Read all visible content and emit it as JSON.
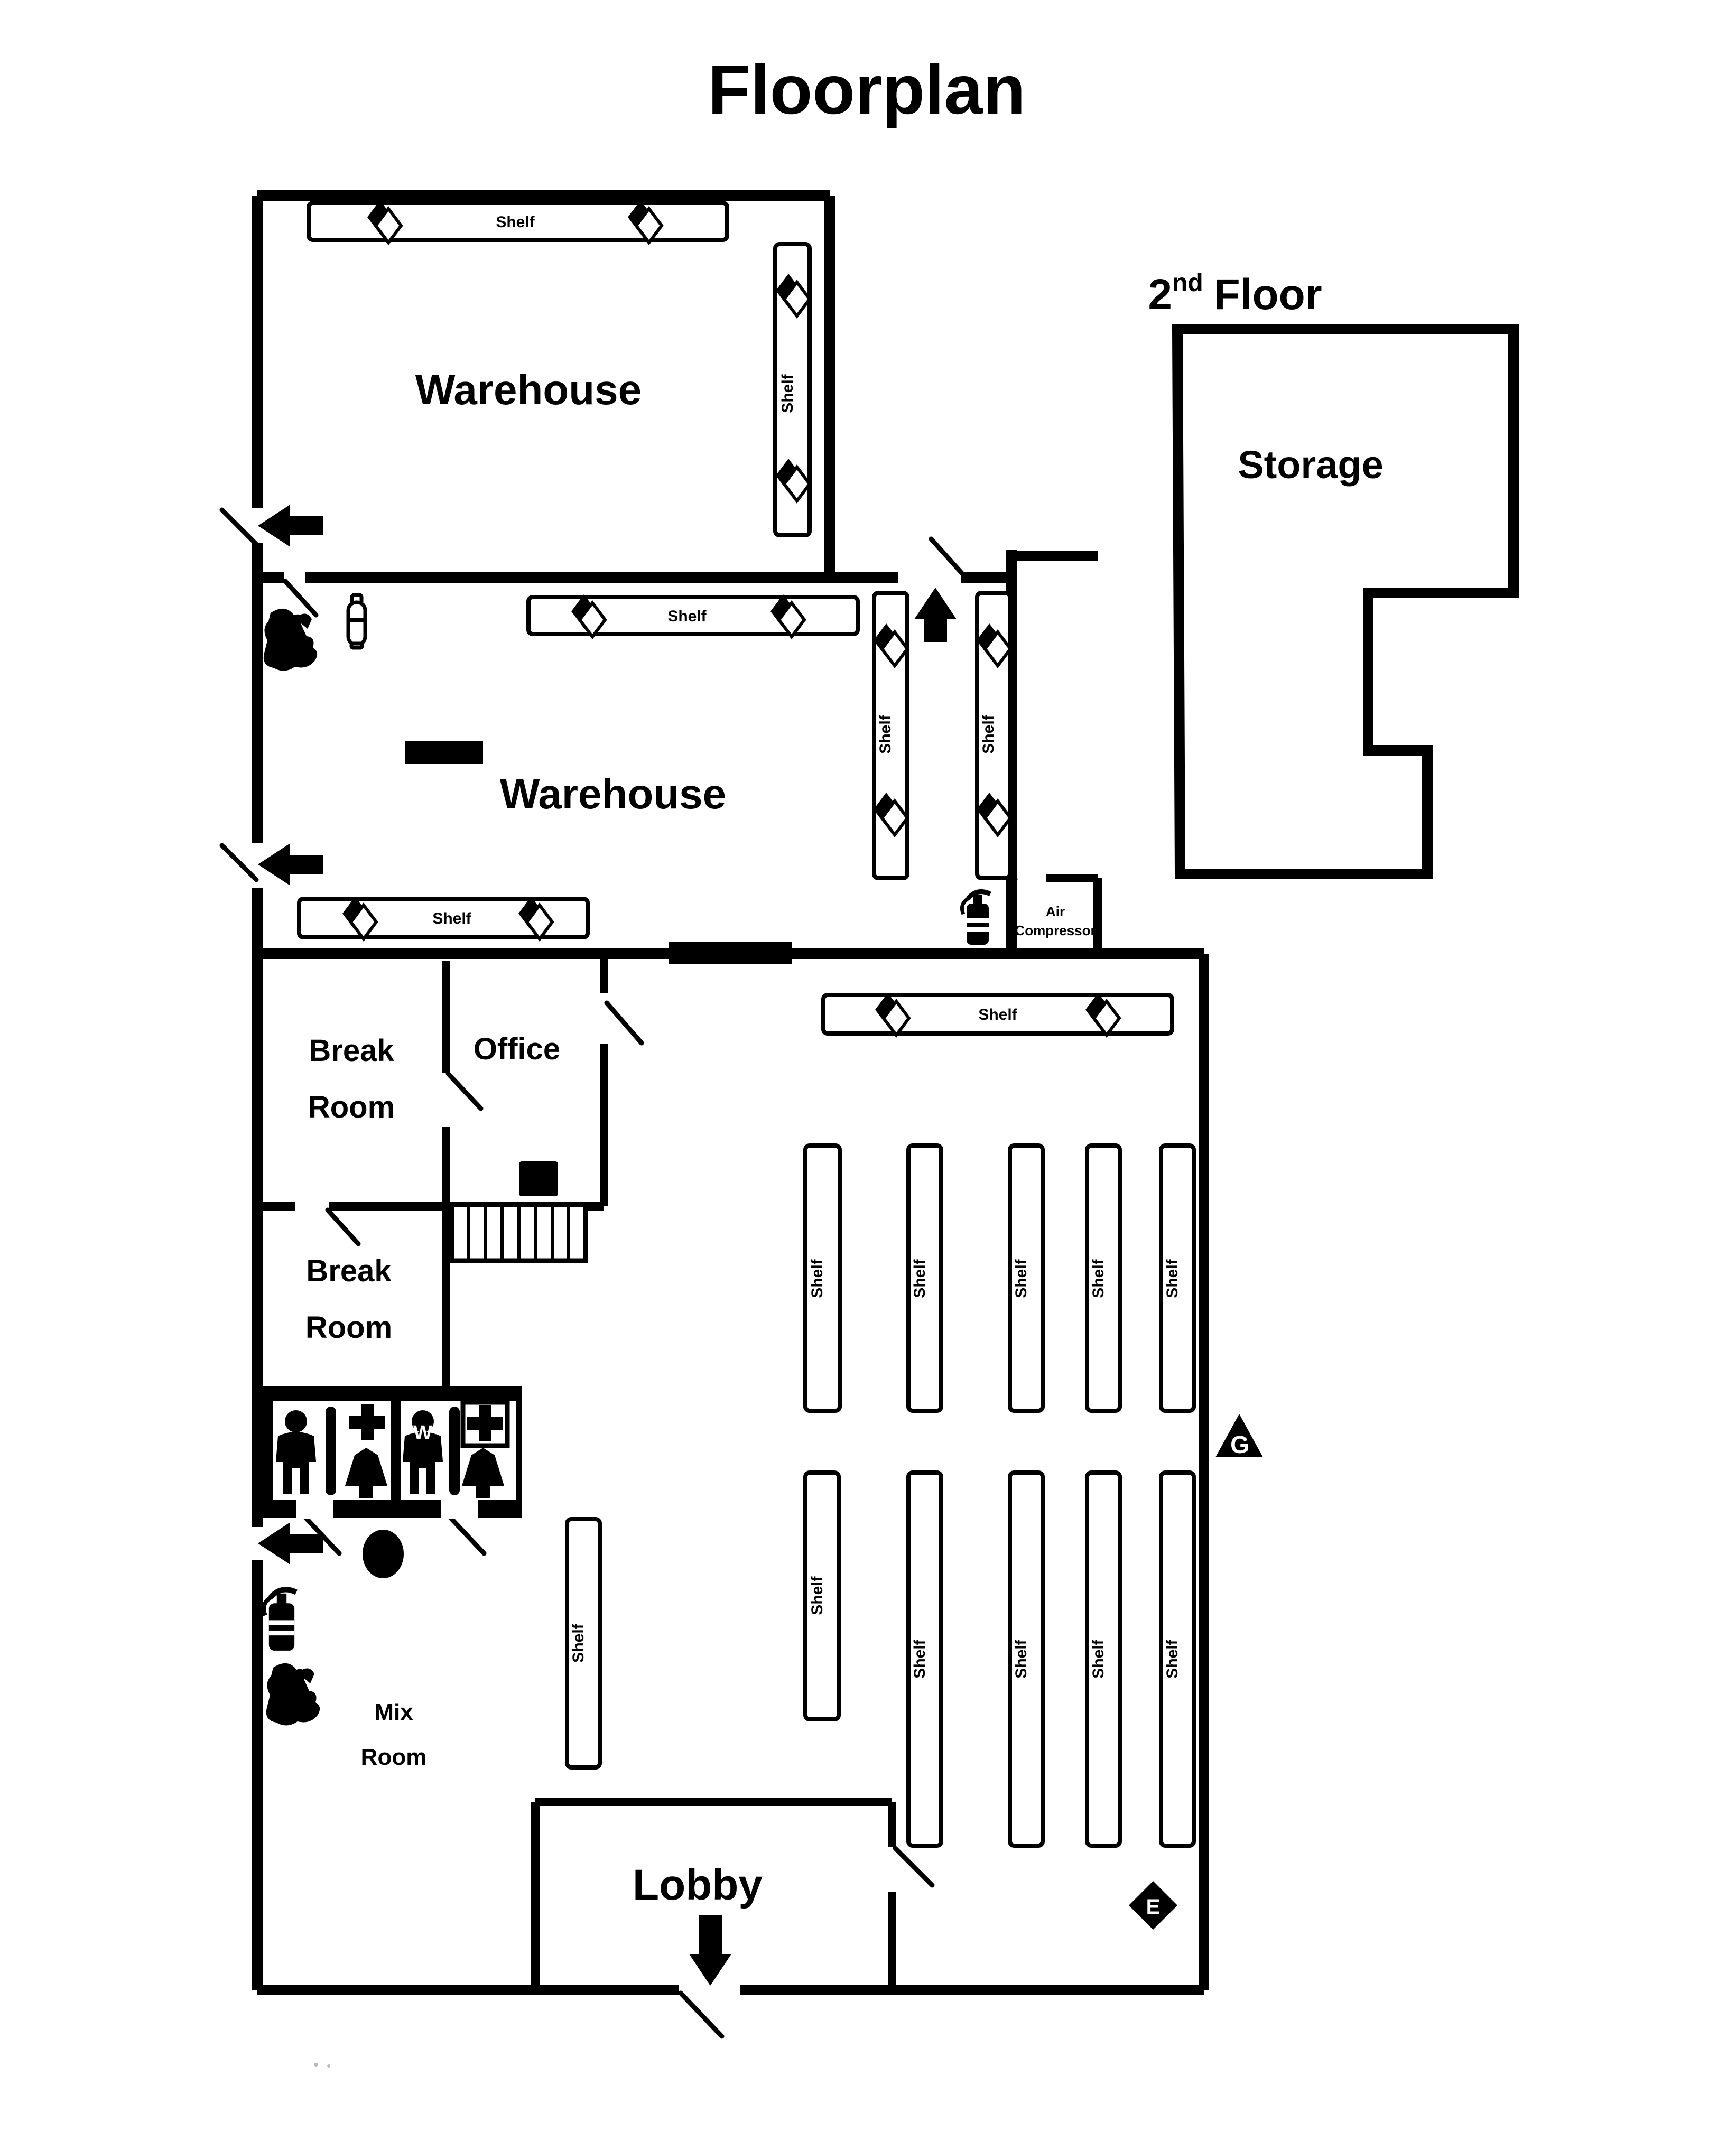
{
  "title": "Floorplan",
  "rooms": {
    "warehouse_upper": "Warehouse",
    "warehouse_lower": "Warehouse",
    "second_floor": {
      "number": "2",
      "ordinal": "nd",
      "word": "Floor"
    },
    "storage": "Storage",
    "break_room_upper": {
      "line1": "Break",
      "line2": "Room"
    },
    "office": "Office",
    "break_room_lower": {
      "line1": "Break",
      "line2": "Room"
    },
    "mix_room": {
      "line1": "Mix",
      "line2": "Room"
    },
    "lobby": "Lobby",
    "air_compressor": {
      "line1": "Air",
      "line2": "Compressor"
    }
  },
  "labels": {
    "shelf": "Shelf"
  },
  "markers": {
    "gas": "G",
    "emergency": "E",
    "women": "W"
  },
  "colors": {
    "ink": "#000000",
    "paper": "#ffffff"
  }
}
